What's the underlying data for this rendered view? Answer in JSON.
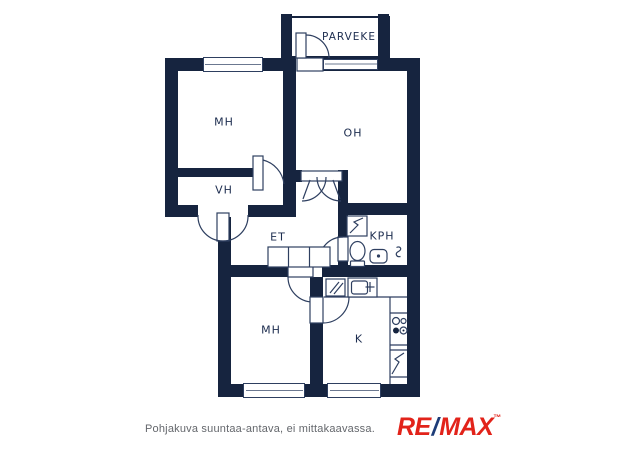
{
  "floorplan": {
    "rooms": [
      {
        "label": "PARVEKE"
      },
      {
        "label": "MH"
      },
      {
        "label": "OH"
      },
      {
        "label": "VH"
      },
      {
        "label": "ET"
      },
      {
        "label": "KPH"
      },
      {
        "label": "MH"
      },
      {
        "label": "K"
      }
    ],
    "wall_color": "#16243f",
    "line_color": "#2e3f60",
    "label_color": "#1d2d4f"
  },
  "footer": {
    "disclaimer": "Pohjakuva suuntaa-antava, ei mittakaavassa."
  },
  "brand": {
    "re": "RE",
    "slash": "/",
    "max": "MAX",
    "tm": "™",
    "red": "#e2231a",
    "blue": "#1d3c78"
  }
}
